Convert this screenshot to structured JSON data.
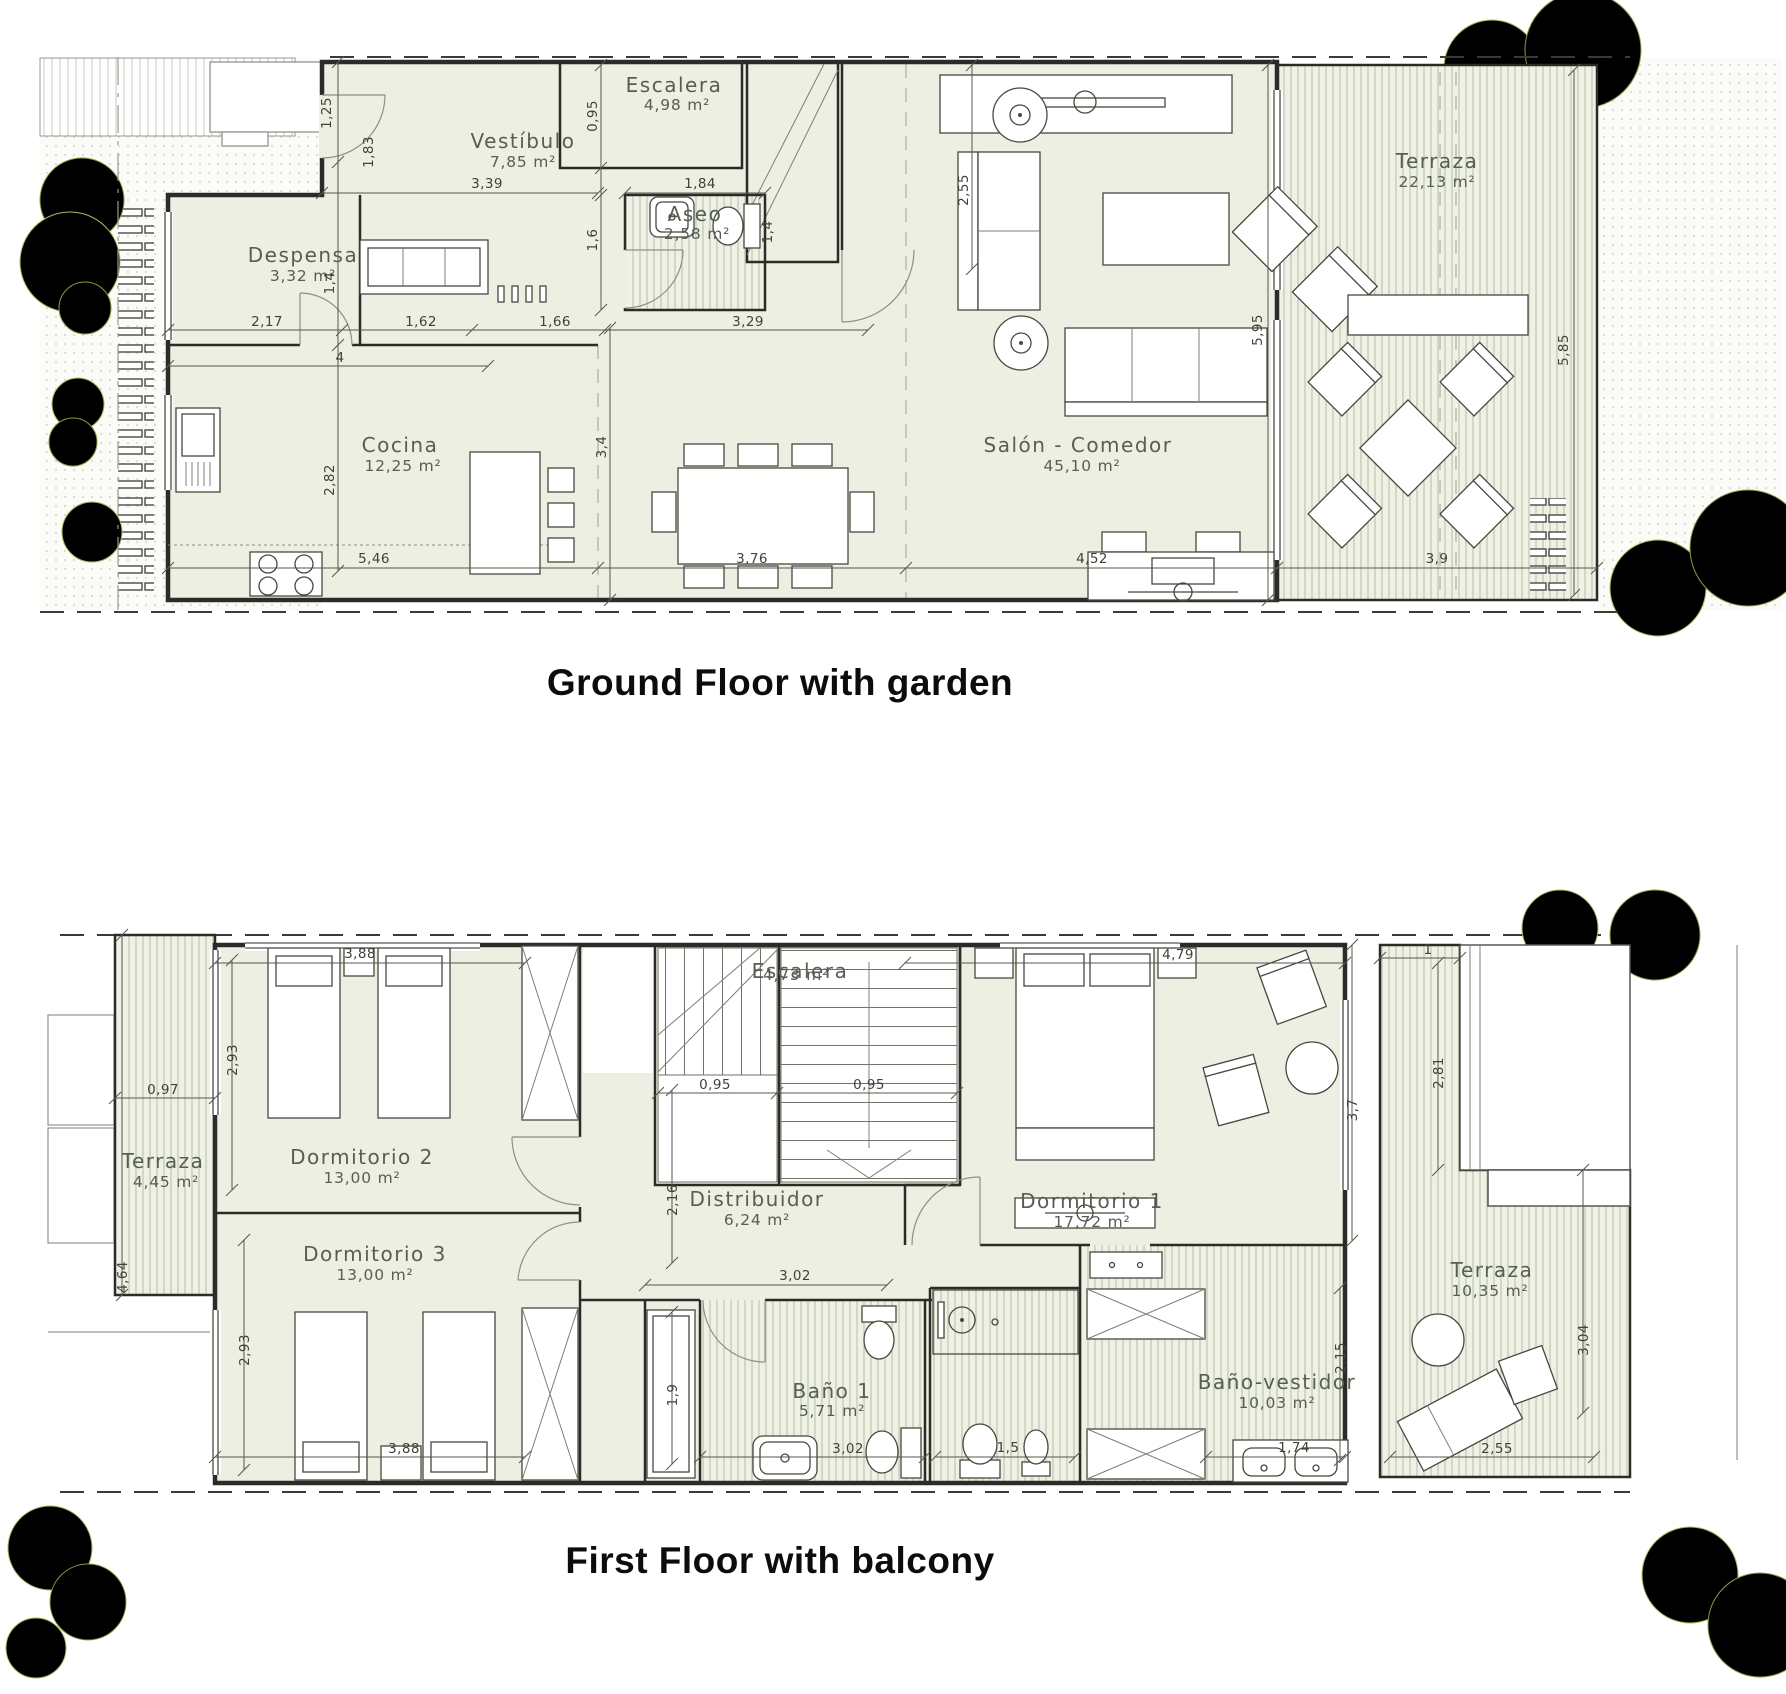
{
  "titles": {
    "ground": "Ground Floor with garden",
    "first": "First Floor with balcony"
  },
  "colors": {
    "room_fill": "#ecefe2",
    "deck_fill": "#eef1e4",
    "wall": "#2b2b28",
    "tree_dark": "#8d9a43",
    "tree_light": "#a7bd62"
  },
  "ground": {
    "rooms": [
      {
        "name": "Despensa",
        "area": "3,32 m²"
      },
      {
        "name": "Vestíbulo",
        "area": "7,85 m²"
      },
      {
        "name": "Escalera",
        "area": "4,98 m²"
      },
      {
        "name": "Aseo",
        "area": "2,58 m²"
      },
      {
        "name": "Cocina",
        "area": "12,25 m²"
      },
      {
        "name": "Salón - Comedor",
        "area": "45,10 m²"
      },
      {
        "name": "Terraza",
        "area": "22,13 m²"
      }
    ],
    "dims": [
      "1,25",
      "1,83",
      "3,39",
      "0,95",
      "1,84",
      "1,6",
      "1,4",
      "2,17",
      "1,4",
      "1,62",
      "1,66",
      "3,29",
      "4",
      "2,82",
      "3,4",
      "2,55",
      "5,95",
      "5,46",
      "3,76",
      "4,52",
      "3,9",
      "5,85"
    ]
  },
  "first": {
    "rooms": [
      {
        "name": "Dormitorio 2",
        "area": "13,00 m²"
      },
      {
        "name": "Dormitorio 3",
        "area": "13,00 m²"
      },
      {
        "name": "Escalera",
        "area": "4,73 m²"
      },
      {
        "name": "Distribuidor",
        "area": "6,24 m²"
      },
      {
        "name": "Dormitorio 1",
        "area": "17,72 m²"
      },
      {
        "name": "Baño 1",
        "area": "5,71 m²"
      },
      {
        "name": "Baño-vestidor",
        "area": "10,03 m²"
      },
      {
        "name": "Terraza",
        "area": "4,45 m²"
      },
      {
        "name": "Terraza",
        "area": "10,35 m²"
      }
    ],
    "dims": [
      "3,88",
      "2,93",
      "0,97",
      "4,64",
      "2,93",
      "3,88",
      "0,95",
      "0,95",
      "2,16",
      "3,02",
      "4,79",
      "3,7",
      "1",
      "2,81",
      "3,04",
      "1,9",
      "3,02",
      "1,5",
      "2,15",
      "1,74",
      "2,55"
    ]
  }
}
